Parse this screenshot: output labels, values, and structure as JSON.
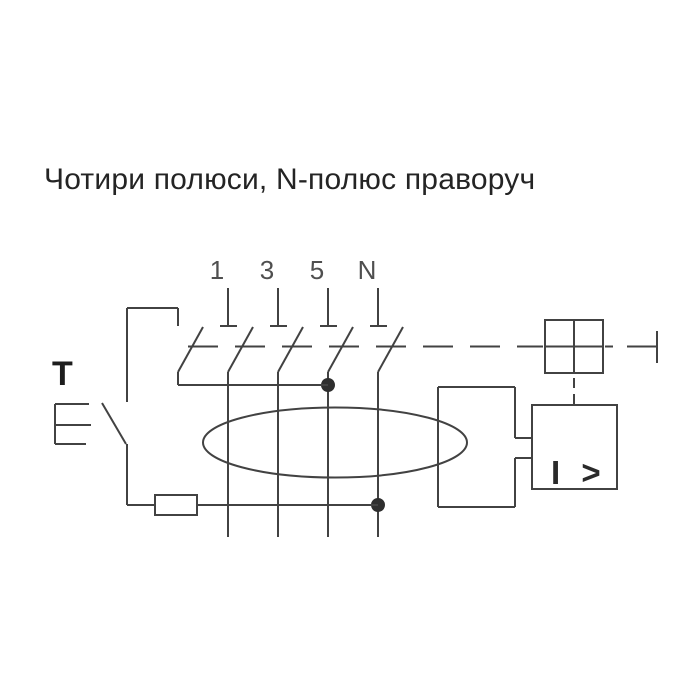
{
  "title": "Чотири полюси, N-полюс праворуч",
  "diagram": {
    "pole_labels": [
      "1",
      "3",
      "5",
      "N"
    ],
    "test_button_label": "T",
    "relay_label": "I >",
    "colors": {
      "background": "#ffffff",
      "line": "#424242",
      "pole_label_text": "#4f4f4f",
      "title_text": "#242424",
      "junction_dot": "#2e2e2e"
    }
  }
}
